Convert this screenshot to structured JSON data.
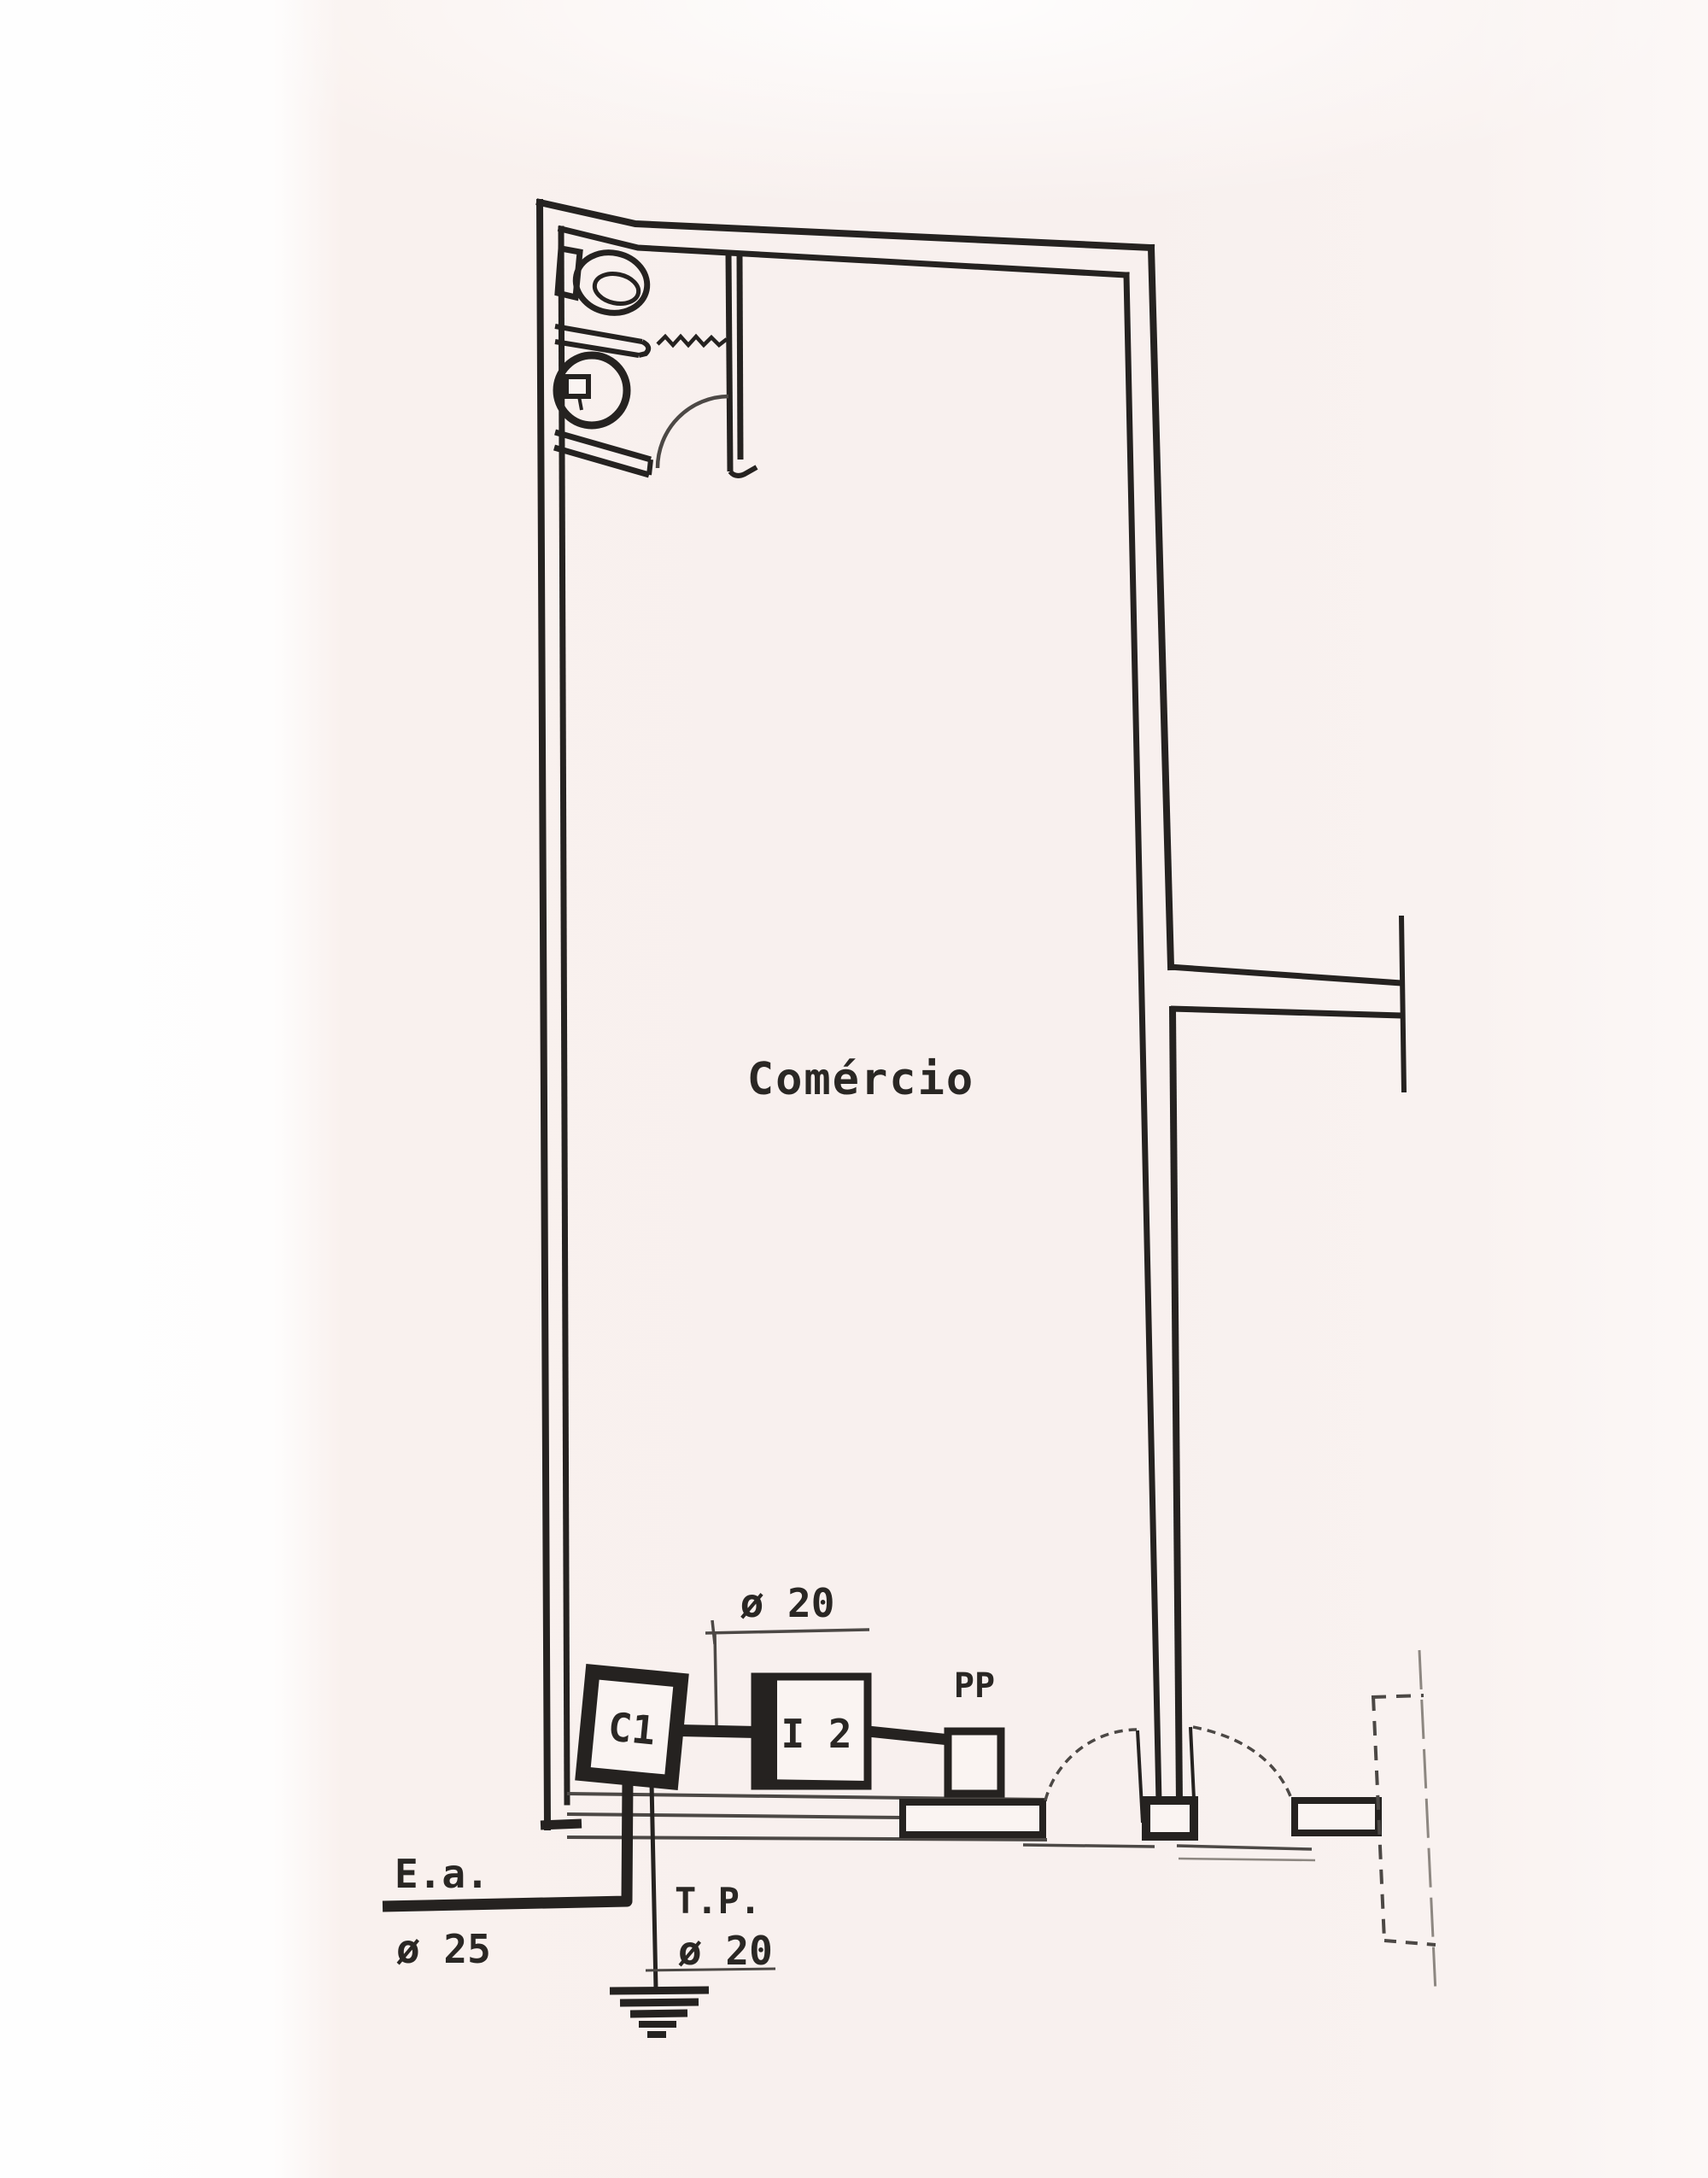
{
  "drawing": {
    "room_label": "Comércio",
    "devices": {
      "c1": "C1",
      "i2": "I 2",
      "pp": "PP"
    },
    "pipes": {
      "top_dim": "ø 20",
      "service_entry_label": "E.a.",
      "service_entry_dim": "ø 25",
      "ground_pipe_label": "T.P.",
      "ground_pipe_dim": "ø 20"
    },
    "colors": {
      "ink": "#252220",
      "paper": "#f8f0ee",
      "paper_light": "#fefdfd"
    }
  }
}
